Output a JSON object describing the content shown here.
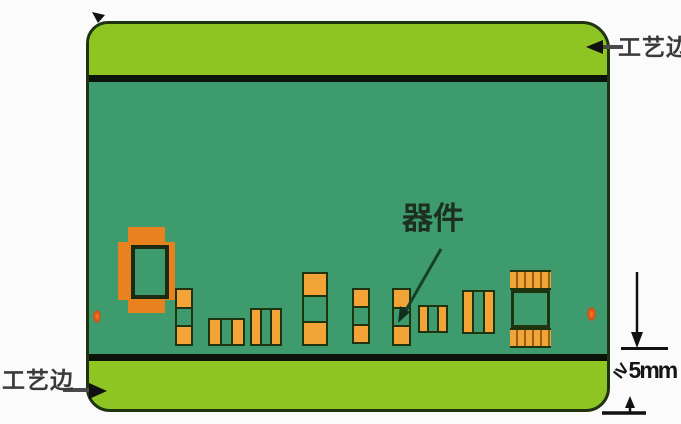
{
  "labels": {
    "process_edge_top": "工艺边",
    "process_edge_bottom": "工艺边",
    "component": "器件"
  },
  "dimension": {
    "symbol": "≥",
    "value": "5mm"
  },
  "components": {
    "count": 10,
    "fiducial_count": 2
  },
  "colors": {
    "background": "#fbfbfb",
    "board_main": "#3d9b6e",
    "process_edge_strip": "#8fc523",
    "separator_black": "#0c130b",
    "outline_dark": "#1f330f",
    "component_pad_orange": "#f2a437",
    "large_component_orange": "#e8821f",
    "fiducial_red": "#d84e15"
  }
}
